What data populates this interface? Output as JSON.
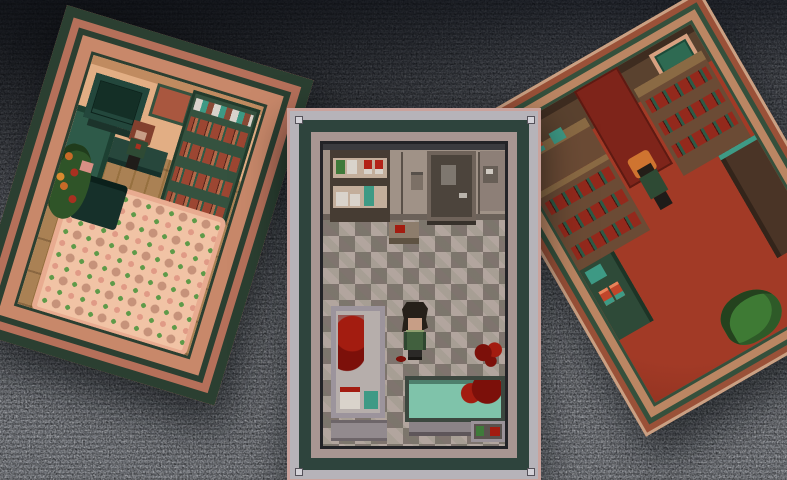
{
  "scene": {
    "description": "Three tilted pixel-art room panels floating over a TV-static background",
    "viewport": {
      "width": 787,
      "height": 480
    },
    "background": {
      "type": "tv-static"
    }
  },
  "rooms": {
    "left": {
      "id": "living-room-panel",
      "tilt_deg": 17,
      "objects": [
        "tv",
        "picture-frame",
        "bookcase",
        "teal-sofa",
        "side-table",
        "table-plant",
        "wood-floor",
        "patterned-rug",
        "flower-plant",
        "dark-couch",
        "pink-object",
        "red-haired-character"
      ]
    },
    "center": {
      "id": "bathroom-panel",
      "tilt_deg": 0,
      "objects": [
        "supply-shelf",
        "green-box",
        "white-box",
        "red-cans",
        "teal-bottle",
        "small-table",
        "door",
        "wall-fixture",
        "intercom-panel",
        "checkered-floor",
        "shower-stall",
        "blood-smear",
        "storage-cabinet",
        "bathtub",
        "tub-blood",
        "floor-blood-splatter",
        "corner-shelf",
        "protagonist-character"
      ]
    },
    "right": {
      "id": "study-panel",
      "tilt_deg": -30,
      "objects": [
        "dark-wall",
        "red-wallpaper",
        "picture-frame",
        "bookshelf-right",
        "bookshelf-left",
        "desk-with-cans",
        "red-carpet",
        "green-bench",
        "tall-cabinet",
        "floor-plant",
        "orange-haired-character"
      ]
    }
  },
  "palette": {
    "static_base": "#75787e",
    "frame_teal": "#2e443d",
    "center_frame_light": "#b6b3b9",
    "center_frame_mauve": "#a89692",
    "center_frame_edge": "#caa29c",
    "center_frame_dark": "#232327",
    "bolt_gray": "#d4d2d8",
    "bath_wall": "#a09287",
    "bath_wall_line": "#6b6159",
    "bath_floor_light": "#b2a59e",
    "bath_floor_dark": "#7f746e",
    "door_face": "#4c443c",
    "door_frame": "#6f635a",
    "door_window": "#7e776f",
    "door_handle": "#b9b3ab",
    "shelf_frame_dark": "#463c33",
    "shelf_face": "#c3ae9b",
    "item_white": "#d9d3cb",
    "item_teal": "#3e9a85",
    "item_red": "#b32318",
    "item_green": "#3f7a3a",
    "shower_frame": "#9c949c",
    "shower_panel": "#b6aeab",
    "cabinet_gray": "#928a8e",
    "tub_fill": "#7fc3aa",
    "tub_rim": "#3c473f",
    "tub_base": "#8b8387",
    "blood_dark": "#7c100a",
    "blood_bright": "#a31c10",
    "char_hair_dark": "#262019",
    "char_skin": "#c79e86",
    "char_jacket": "#41603e",
    "char_scarf": "#8fa06f",
    "char_pants": "#2b2927",
    "left_frame_green": "#2b3f31",
    "left_frame_salmon": "#b5705a",
    "left_frame_salmon_light": "#c8886a",
    "left_wall_peach": "#e2ae84",
    "left_wall_trim": "#c08b60",
    "wood_light": "#aa8154",
    "wood_dark": "#96703f",
    "rug_base": "#f1c3a5",
    "rug_border": "#e8ab90",
    "rug_green": "#5f9a49",
    "rug_tile": "#c6927a",
    "tv_body": "#23473c",
    "tv_screen": "#142f26",
    "couch_teal": "#2e5a49",
    "couch_dark": "#16302a",
    "bookcase_green": "#35523f",
    "book_red": "#9c4632",
    "book_dark": "#54241a",
    "plant_green": "#2f5428",
    "plant_orange": "#c76a28",
    "left_char_hair": "#83402e",
    "right_frame_edge": "#caa083",
    "right_frame_red": "#9a5138",
    "right_frame_green": "#35503c",
    "right_frame_tan": "#bb8663",
    "study_wall": "#5a422f",
    "study_wall_dark": "#3e2c20",
    "wallpaper_red": "#7e241a",
    "study_wood": "#8a6a44",
    "study_shelf": "#6b4b35",
    "carpet_red": "#a23a26",
    "carpet_dark": "#7c2a1a",
    "pic_border": "#d8a080",
    "pic_teal": "#2e6a52",
    "can_orange": "#c0452a",
    "bench_green": "#2e4a38",
    "cab_brown": "#4a3426",
    "study_book_red": "#93291c",
    "study_book_teal": "#2e5a46",
    "right_char_hair": "#cf7430",
    "body_green": "#2e4a34",
    "leg_dark": "#1f1c19"
  }
}
